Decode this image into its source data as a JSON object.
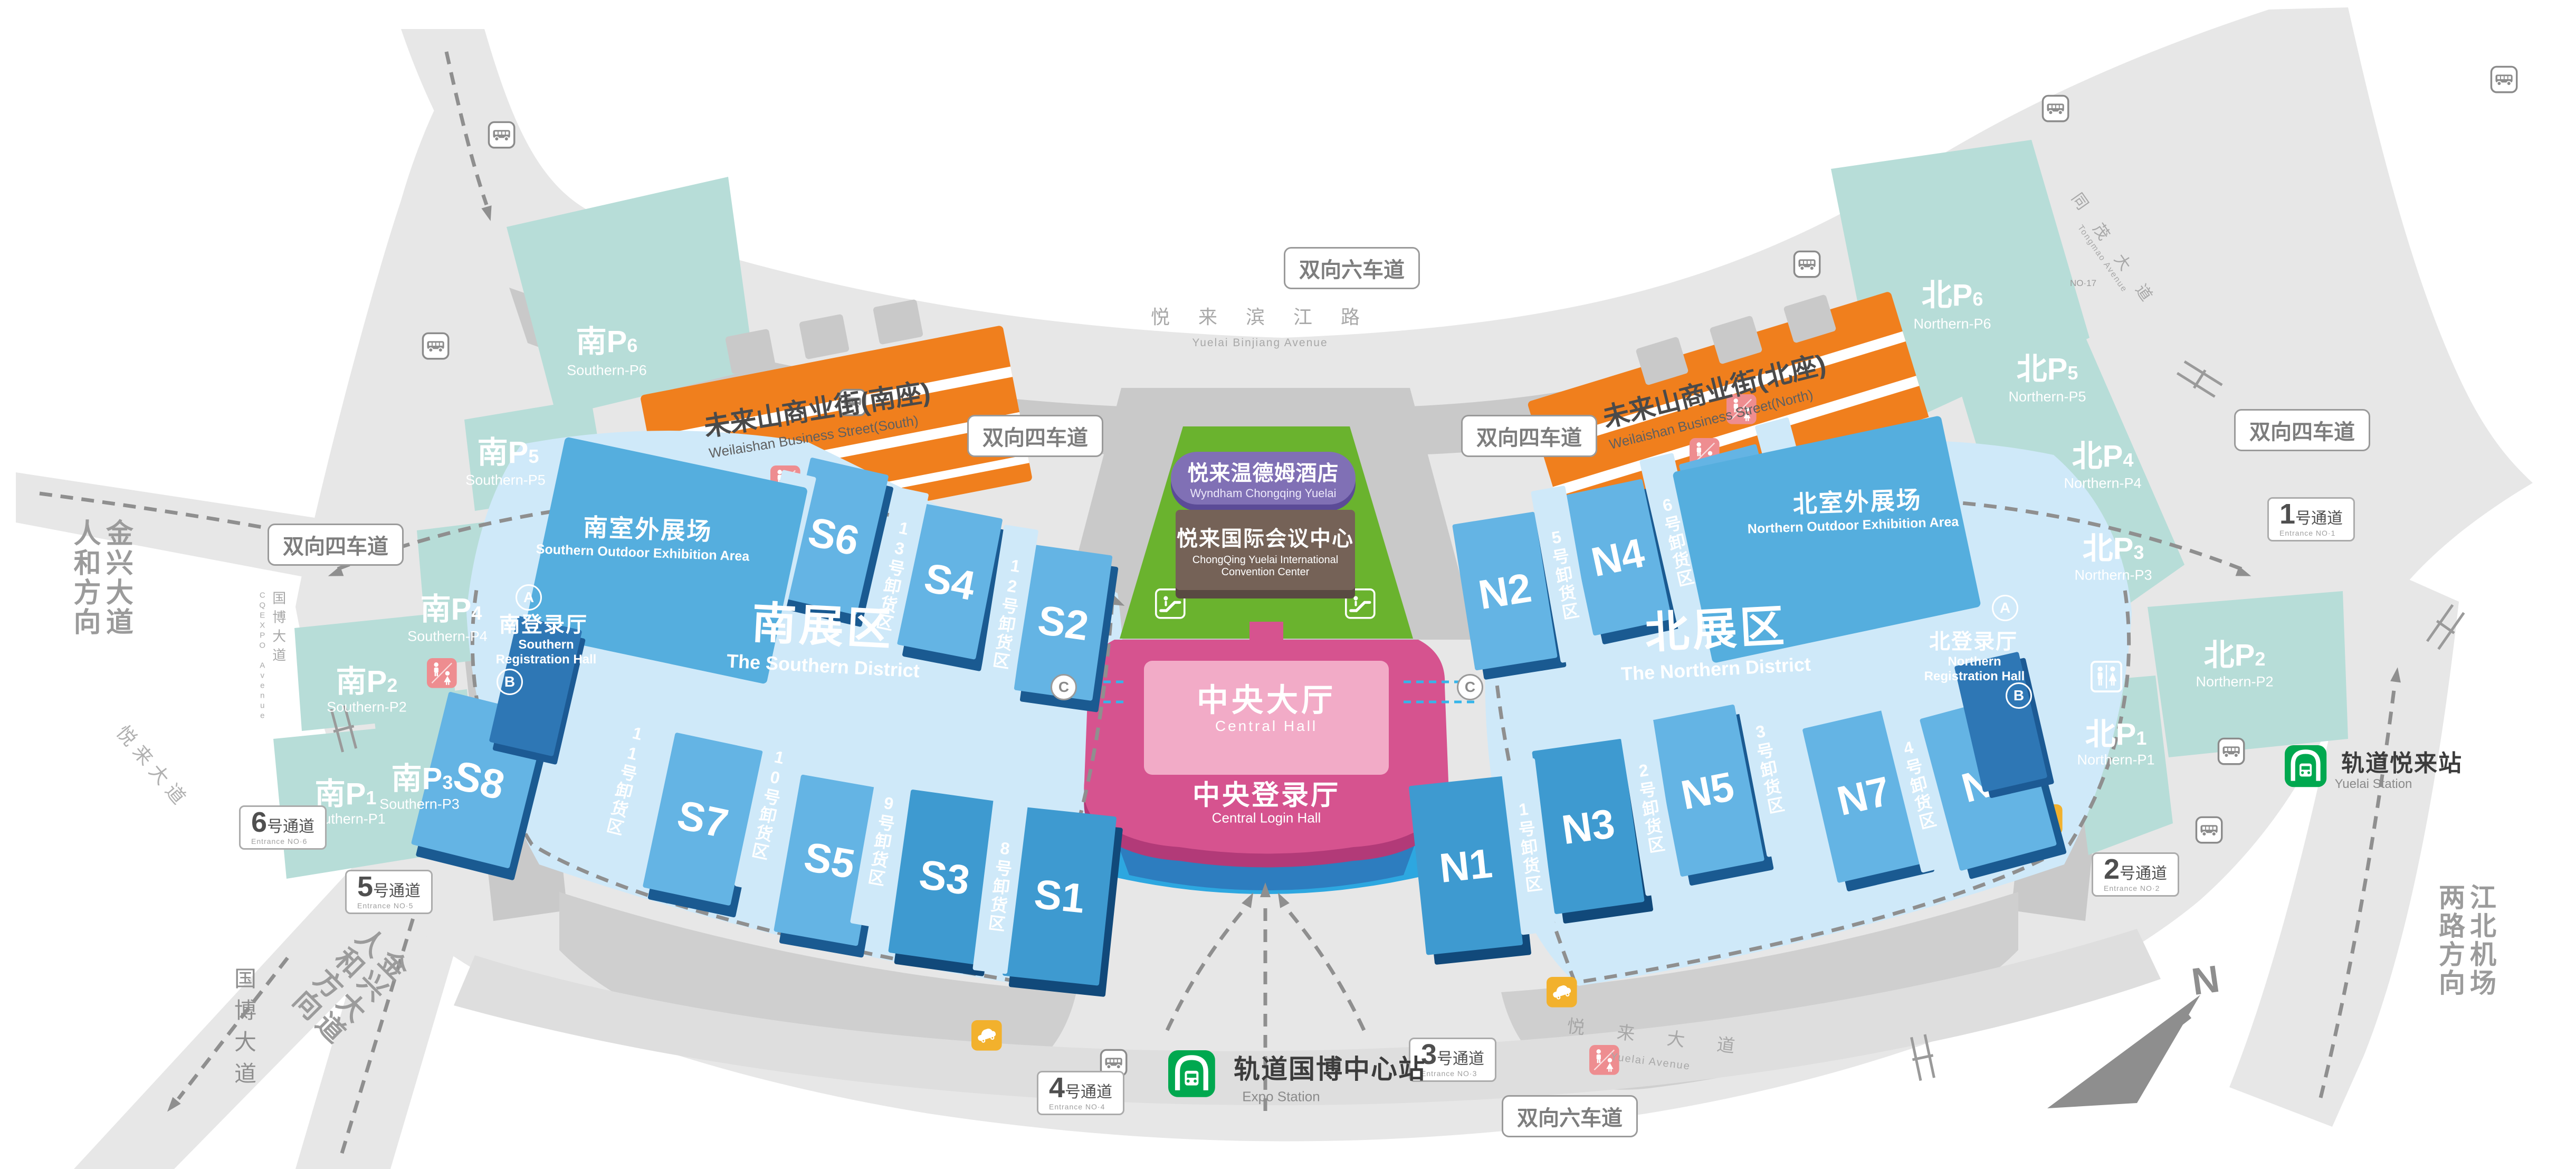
{
  "signs": {
    "lane4": "双向四车道",
    "lane6": "双向六车道"
  },
  "entrances": [
    {
      "n": "1",
      "t": "号通道",
      "en": "Entrance NO·1"
    },
    {
      "n": "2",
      "t": "号通道",
      "en": "Entrance NO·2"
    },
    {
      "n": "3",
      "t": "号通道",
      "en": "Entrance NO·3"
    },
    {
      "n": "4",
      "t": "号通道",
      "en": "Entrance NO·4"
    },
    {
      "n": "5",
      "t": "号通道",
      "en": "Entrance NO·5"
    },
    {
      "n": "6",
      "t": "号通道",
      "en": "Entrance NO·6"
    }
  ],
  "parking": {
    "south": [
      {
        "p": "南P",
        "n": "1",
        "en": "Southern-P1"
      },
      {
        "p": "南P",
        "n": "2",
        "en": "Southern-P2"
      },
      {
        "p": "南P",
        "n": "3",
        "en": "Southern-P3"
      },
      {
        "p": "南P",
        "n": "4",
        "en": "Southern-P4"
      },
      {
        "p": "南P",
        "n": "5",
        "en": "Southern-P5"
      },
      {
        "p": "南P",
        "n": "6",
        "en": "Southern-P6"
      }
    ],
    "north": [
      {
        "p": "北P",
        "n": "1",
        "en": "Northern-P1"
      },
      {
        "p": "北P",
        "n": "2",
        "en": "Northern-P2"
      },
      {
        "p": "北P",
        "n": "3",
        "en": "Northern-P3"
      },
      {
        "p": "北P",
        "n": "4",
        "en": "Northern-P4"
      },
      {
        "p": "北P",
        "n": "5",
        "en": "Northern-P5"
      },
      {
        "p": "北P",
        "n": "6",
        "en": "Northern-P6"
      }
    ]
  },
  "halls": {
    "south": [
      "S1",
      "S2",
      "S3",
      "S4",
      "S5",
      "S6",
      "S7",
      "S8"
    ],
    "north": [
      "N1",
      "N2",
      "N3",
      "N4",
      "N5",
      "N6",
      "N7",
      "N8"
    ]
  },
  "unloading": {
    "south": [
      "8号卸货区",
      "9号卸货区",
      "10号卸货区",
      "11号卸货区",
      "12号卸货区",
      "13号卸货区",
      "14号卸货区"
    ],
    "north": [
      "1号卸货区",
      "2号卸货区",
      "3号卸货区",
      "4号卸货区",
      "5号卸货区",
      "6号卸货区",
      "7号卸货区"
    ]
  },
  "districts": {
    "south": {
      "zh": "南展区",
      "en": "The Southern District"
    },
    "north": {
      "zh": "北展区",
      "en": "The Northern District"
    }
  },
  "outdoor": {
    "south": {
      "zh": "南室外展场",
      "en": "Southern Outdoor Exhibition Area"
    },
    "north": {
      "zh": "北室外展场",
      "en": "Northern Outdoor Exhibition Area"
    }
  },
  "registration": {
    "south": {
      "zh": "南登录厅",
      "en1": "Southern",
      "en2": "Registration Hall"
    },
    "north": {
      "zh": "北登录厅",
      "en1": "Northern",
      "en2": "Registration Hall"
    },
    "gateA": "A",
    "gateB": "B"
  },
  "center": {
    "hotel": {
      "zh": "悦来温德姆酒店",
      "en": "Wyndham Chongqing Yuelai"
    },
    "convention": {
      "zh": "悦来国际会议中心",
      "en1": "ChongQing Yuelai International",
      "en2": "Convention Center"
    },
    "hall": {
      "zh": "中央大厅",
      "en": "Central Hall"
    },
    "login": {
      "zh": "中央登录厅",
      "en": "Central Login Hall"
    }
  },
  "stations": {
    "expo": {
      "zh": "轨道国博中心站",
      "en": "Expo Station"
    },
    "yuelai": {
      "zh": "轨道悦来站",
      "en": "Yuelai Station"
    }
  },
  "streets": {
    "south": {
      "zh": "未来山商业街(南座)",
      "en": "Weilaishan Business Street(South)"
    },
    "north": {
      "zh": "未来山商业街(北座)",
      "en": "Weilaishan Business Street(North)"
    }
  },
  "roads": {
    "binjiang": {
      "zh": "悦 来 滨 江 路",
      "en": "Yuelai Binjiang Avenue"
    },
    "guobo": {
      "zh": "国博大道",
      "en": "CQEXPO Avenue"
    },
    "guobo2": "国博大道",
    "yuelai": {
      "zh": "悦 来 大 道",
      "en": "Yuelai Avenue"
    },
    "yuelai2": "悦来大道",
    "tongmao": {
      "zh": "同 茂 大 道",
      "en": "Tongmao Avenue"
    }
  },
  "directions": {
    "jinxing": {
      "l1": "金兴大道",
      "l2": "人和方向"
    },
    "airport": {
      "l1": "江北机场",
      "l2": "两路方向"
    }
  },
  "compass": {
    "n": "N"
  },
  "misc": {
    "no17": "NO·17",
    "corridor": "C"
  },
  "colors": {
    "orange": "#f07f1d",
    "green": "#6ab32e",
    "purple": "#8070b5",
    "brown": "#756257",
    "pink": "#d6538f",
    "pinkLight": "#f2abc7",
    "hallBlue": "#64b4e4",
    "hallDark": "#1a5a91",
    "teal": "#b7ddd8",
    "platform": "#cfe9f9",
    "metroGreen": "#00a84f",
    "taxiYellow": "#f2b12d",
    "restroomPink": "#ee8d90",
    "regBlue": "#2e77b5",
    "ground": "#e7e7e7"
  }
}
